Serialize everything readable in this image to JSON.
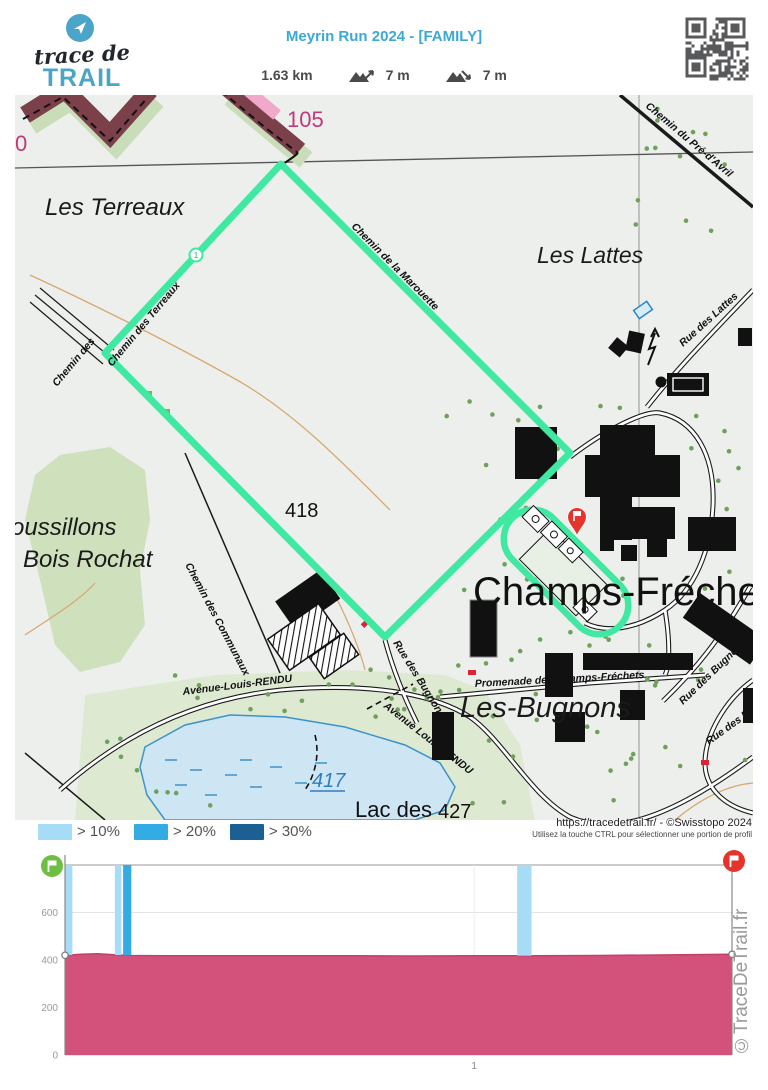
{
  "header": {
    "logo": {
      "line1": "trace de",
      "line2": "TRAIL"
    },
    "title": "Meyrin Run 2024 - [FAMILY]",
    "stats": {
      "distance": "1.63 km",
      "ascent": "7 m",
      "descent": "7 m"
    }
  },
  "map": {
    "labels": {
      "les_terreaux": "Les Terreaux",
      "les_lattes": "Les Lattes",
      "champs_frechets": "Champs-Fréchets",
      "les_bugnons": "Les-Bugnons",
      "bois_rochat": "Bois Rochat",
      "roussillons": "oussillons",
      "lac_des": "Lac des",
      "alt_417": "417",
      "alt_418": "418",
      "alt_427": "427",
      "alt_105": "105",
      "alt_0": "0",
      "km_marker": "1"
    },
    "roads": {
      "marouette": "Chemin de la Marouette",
      "terreaux": "Chemin des Terreaux",
      "chemin_des": "Chemin des",
      "communaux": "Chemin des Communaux",
      "pre_davril": "Chemin du Pré-d'Avril",
      "rue_lattes": "Rue des Lattes",
      "rue_bugnons_a": "Rue des Bugnons",
      "rue_bugnons_b": "Rue des Bugnons",
      "rue_b_partial": "Rue des B",
      "promenade": "Promenade des Champs-Fréchets",
      "avenue_a": "Avenue-Louis-RENDU",
      "avenue_b": "Avenue Louis-RENDU"
    },
    "route_color": "#3FE9A1",
    "attribution": {
      "line1": "https://tracedetrail.fr/ - ©Swisstopo 2024",
      "line2": "Utilisez la touche CTRL pour sélectionner une portion de profil"
    }
  },
  "legend": {
    "items": [
      {
        "label": "> 10%",
        "color": "#A6DCF5"
      },
      {
        "label": "> 20%",
        "color": "#33ACE3"
      },
      {
        "label": "> 30%",
        "color": "#1C5F92"
      }
    ]
  },
  "watermark": "©TraceDeTrail.fr",
  "chart_data": {
    "type": "area",
    "title": "Elevation profile",
    "x_unit": "km",
    "y_unit": "m",
    "xlim": [
      0,
      1.63
    ],
    "ylim": [
      0,
      800
    ],
    "x_ticks": [
      1
    ],
    "y_ticks": [
      0,
      200,
      400,
      600,
      800
    ],
    "grid": true,
    "colors": {
      "area": "#D2527B",
      "area_line": "#C23F66",
      "start": "#6FBE44",
      "end": "#E6342C"
    },
    "profile": [
      [
        0,
        420
      ],
      [
        0.04,
        424
      ],
      [
        0.08,
        426
      ],
      [
        0.12,
        422
      ],
      [
        0.16,
        419
      ],
      [
        0.25,
        418
      ],
      [
        0.4,
        418
      ],
      [
        0.55,
        418
      ],
      [
        0.7,
        418
      ],
      [
        0.85,
        417
      ],
      [
        1.0,
        418
      ],
      [
        1.15,
        418
      ],
      [
        1.3,
        419
      ],
      [
        1.45,
        421
      ],
      [
        1.63,
        424
      ]
    ],
    "steep_segments": [
      {
        "from": 0.0,
        "to": 0.018,
        "grade": "> 10%"
      },
      {
        "from": 0.122,
        "to": 0.138,
        "grade": "> 10%"
      },
      {
        "from": 0.142,
        "to": 0.162,
        "grade": "> 20%"
      },
      {
        "from": 1.105,
        "to": 1.14,
        "grade": "> 10%"
      }
    ]
  }
}
